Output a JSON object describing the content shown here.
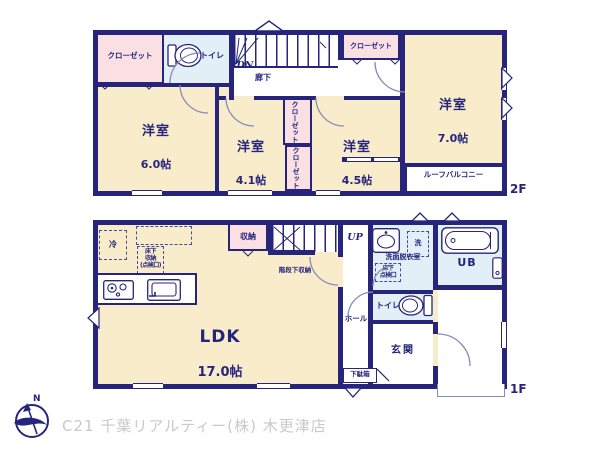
{
  "colors": {
    "wall_navy": "#26257b",
    "room_cream": "#f8eccb",
    "closet_pink": "#fadfe3",
    "wet_area_blue": "#e2eff7",
    "footer_gray": "#c9c9c9"
  },
  "floor2": {
    "floor_label": "2F",
    "closet_top_left": "クローゼット",
    "closet_top_right": "クローゼット",
    "closet_mid_upper": "クローゼット",
    "closet_mid_lower": "クローゼット",
    "toilet": "トイレ",
    "stairs_dn": "DN",
    "hallway": "廊下",
    "bedroom_6": {
      "name": "洋室",
      "size": "6.0帖"
    },
    "bedroom_41": {
      "name": "洋室",
      "size": "4.1帖"
    },
    "bedroom_45": {
      "name": "洋室",
      "size": "4.5帖"
    },
    "bedroom_7": {
      "name": "洋室",
      "size": "7.0帖"
    },
    "roof_balcony": "ルーフバルコニー"
  },
  "floor1": {
    "floor_label": "1F",
    "fridge": "冷",
    "underfloor_storage": "床下\n収納\n(点検口)",
    "storage": "収納",
    "stairs_up": "UP",
    "under_stair_storage": "階段下収納",
    "washroom": "洗面脱衣室",
    "washer": "洗",
    "underfloor_hatch": "床下\n点検口",
    "unit_bath": "UB",
    "toilet": "トイレ",
    "hall": "ホール",
    "entrance": "玄関",
    "shoe_cabinet": "下駄箱",
    "ldk": {
      "name": "LDK",
      "size": "17.0帖"
    }
  },
  "footer": {
    "compass_north": "N",
    "company": "C21 千葉リアルティー(株) 木更津店"
  }
}
